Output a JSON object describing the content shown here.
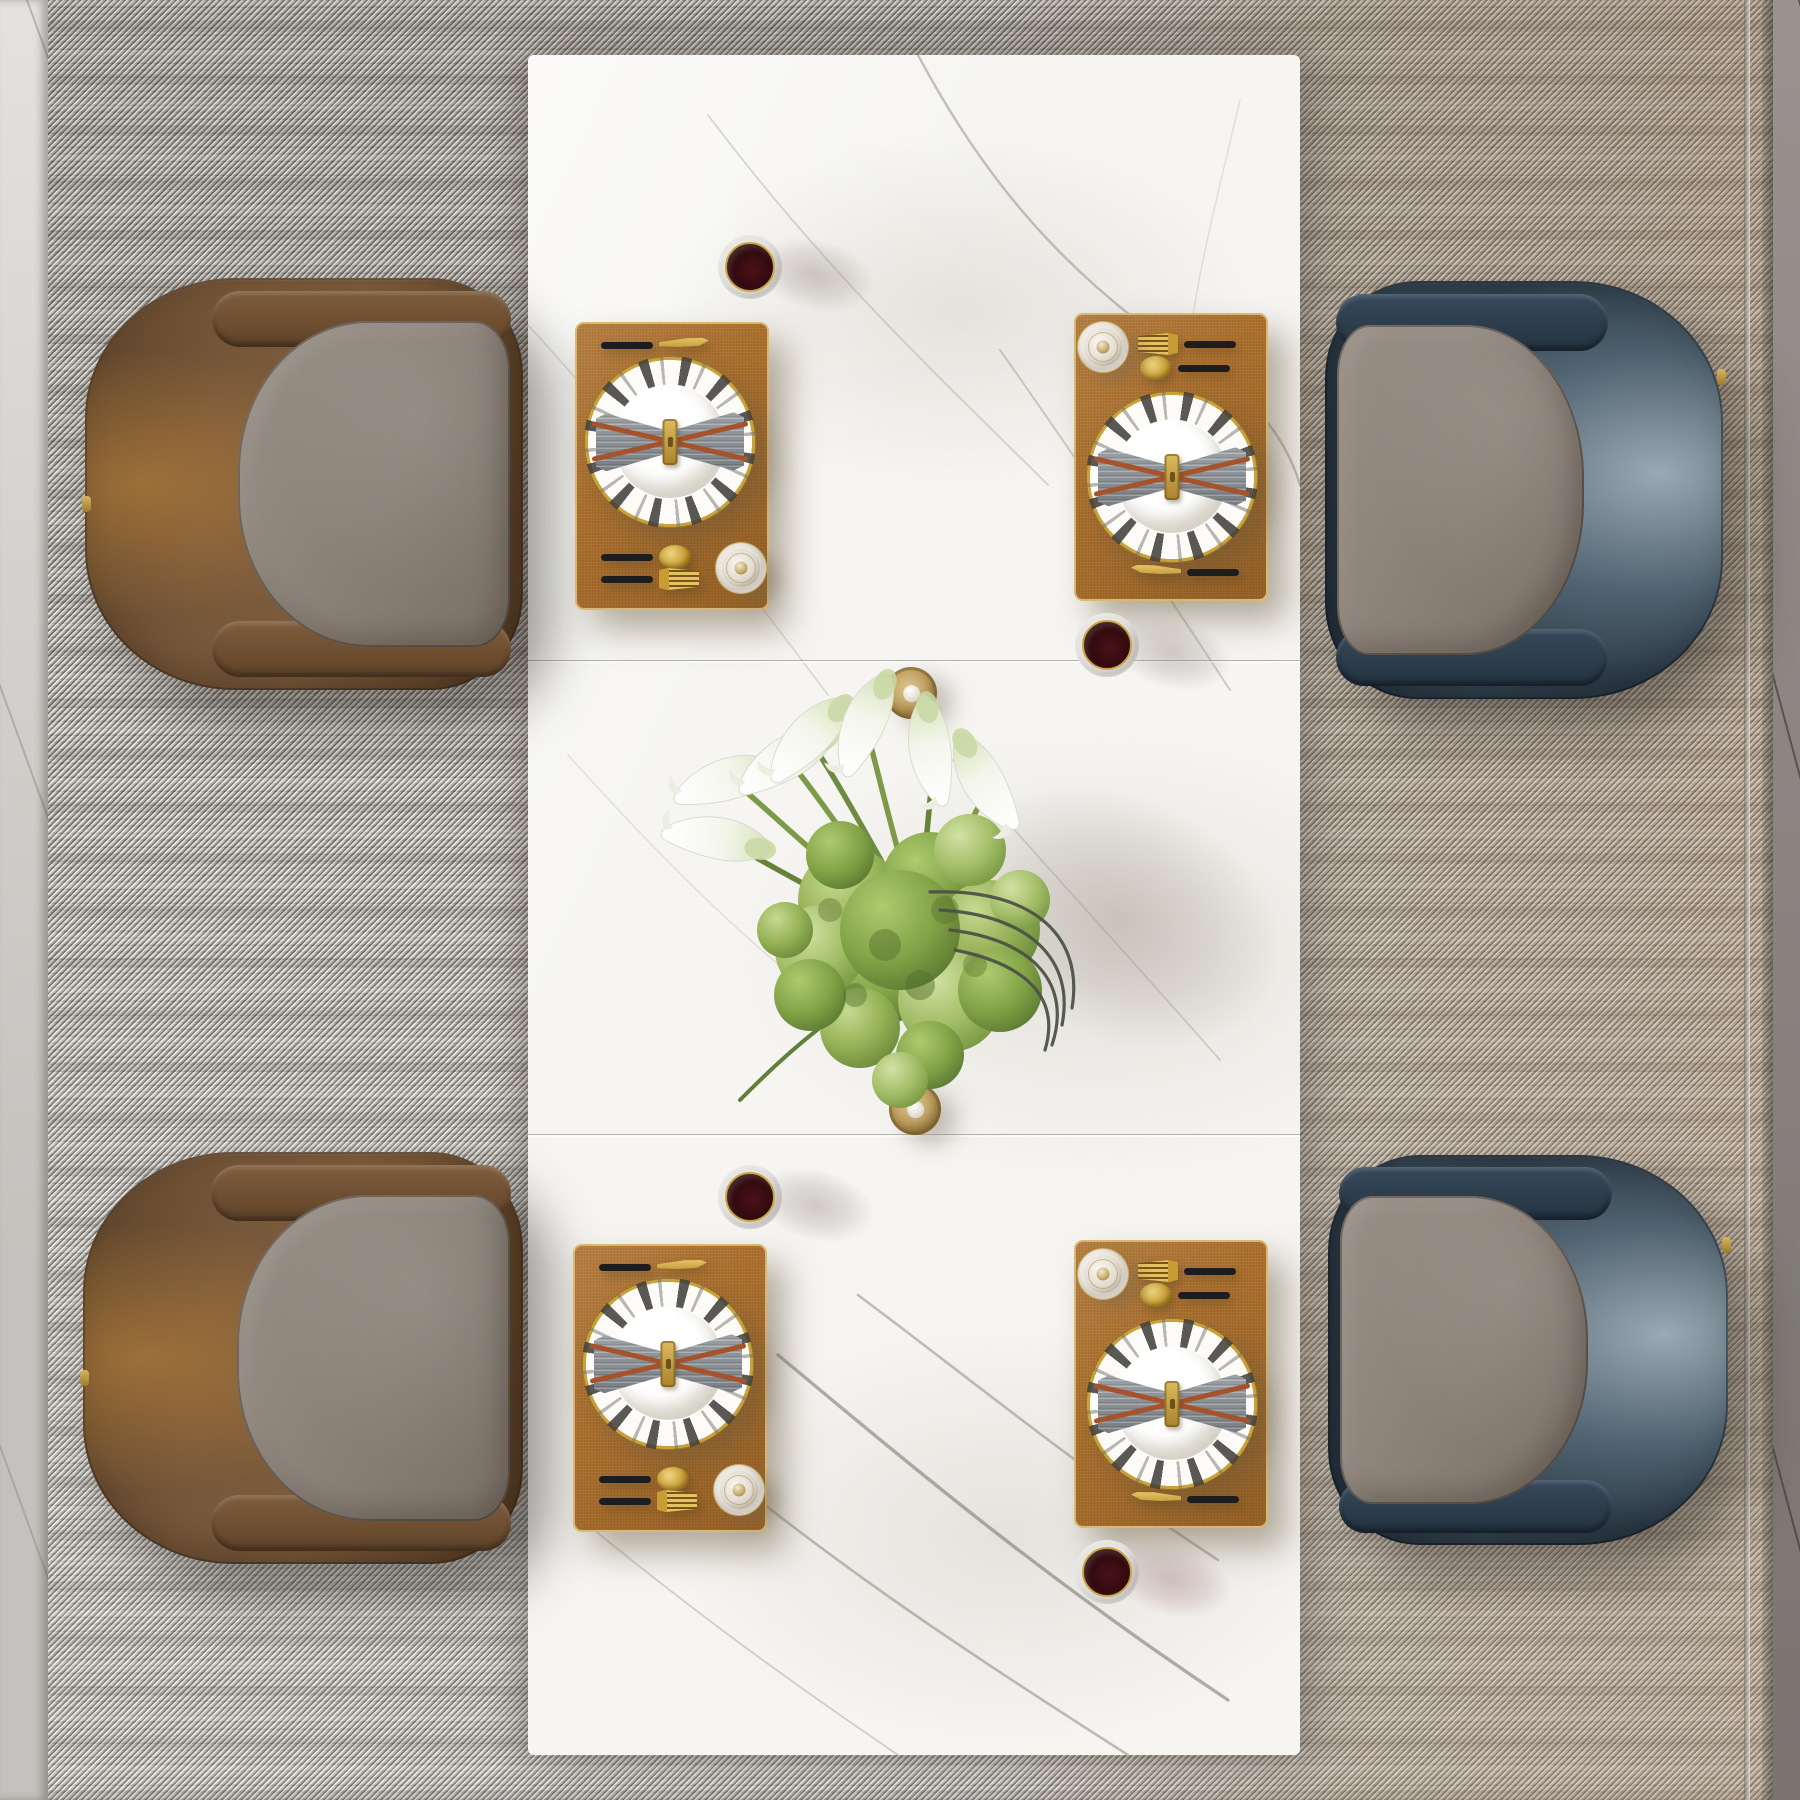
{
  "scene": {
    "view": "top-down render",
    "setting": "modern rectangular dining table for four set on a woven tweed rug",
    "visible_text": "none"
  },
  "palette": {
    "table_marble": "#f6f5f2",
    "marble_vein": "#8d8882",
    "placemat": "#ab6f2c",
    "placemat_trim": "#d9b872",
    "napkin": "#878d93",
    "napkin_strap": "#a6532b",
    "cutlery_handle": "#1d1d1f",
    "cutlery_gold": "#c9a544",
    "wine": "#2d080d",
    "chair_brown": "#6f5133",
    "chair_blue": "#2c3945",
    "chair_cushion": "#8b8177",
    "rug": "#cbc7bf",
    "floor_left": "#d5d3cf",
    "floor_right": "#8a8480",
    "foliage_green": "#8fae52",
    "lily_white": "#f4f6ec",
    "gold_accent": "#b9985a"
  },
  "table": {
    "material": "white marble",
    "segments": 3
  },
  "place_settings": {
    "count": 4,
    "items": [
      "tan leather placemat with gold trim",
      "geometric black-and-white rimmed dinner plate",
      "gray napkin folded as a bow with leather straps and gold buckle",
      "black-and-gold knife",
      "black-and-gold spoon",
      "black-and-gold fork",
      "water glass with gold rim",
      "wine glass of red wine"
    ]
  },
  "centerpiece": {
    "flowers": "white calla lilies",
    "foliage": "green hydrangea ball",
    "vase": "glass vase with dark wire loops",
    "accessories": [
      "gold candle holder with pearl (upper)",
      "gold candle holder with pearl (lower)"
    ]
  },
  "chairs": {
    "left_pair": "cognac brown leather armchairs with taupe cushions",
    "right_pair": "ink-blue leather armchairs with taupe cushions"
  },
  "floor": {
    "left_strip": "light gray marble",
    "right_strip": "dark gray marble",
    "rug": "black-and-white tweed weave, warmer toward the right edge"
  }
}
